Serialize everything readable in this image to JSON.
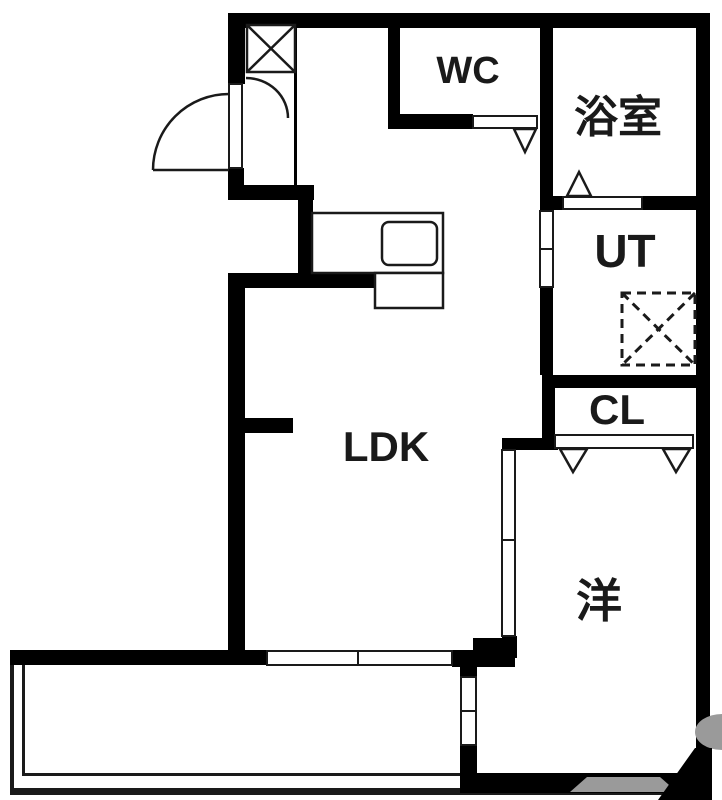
{
  "floorplan": {
    "kind": "japanese-apartment-floor-plan",
    "rooms": {
      "wc": {
        "label": "WC"
      },
      "bath": {
        "label": "浴室"
      },
      "utility": {
        "label": "UT"
      },
      "closet": {
        "label": "CL"
      },
      "ldk": {
        "label": "LDK"
      },
      "western": {
        "label": "洋"
      }
    },
    "symbols": {
      "x_box": "pipe-space-or-storage",
      "dashed_x_box": "washing-machine-space",
      "door_arc": "hinged-entrance-door",
      "triangles": "door-opening-markers"
    },
    "colors": {
      "wall": "#000000",
      "floor": "#ffffff",
      "line": "#1a1a1a",
      "watermark": "#9a9a9a"
    }
  }
}
